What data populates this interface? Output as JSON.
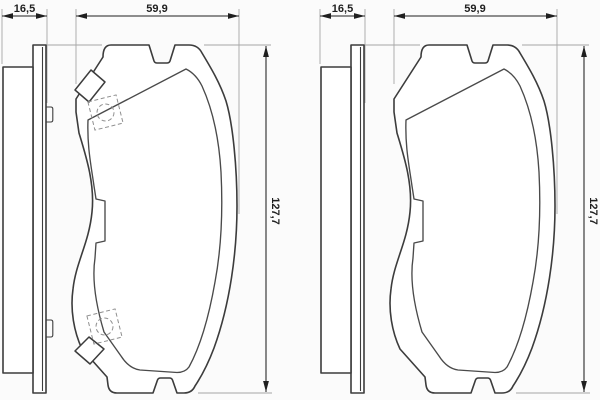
{
  "drawing": {
    "left_view": {
      "thickness": "16,5",
      "width": "59,9",
      "height": "127,7"
    },
    "right_view": {
      "thickness": "16,5",
      "width": "59,9",
      "height": "127,7"
    }
  },
  "colors": {
    "background": "#fbfbfb",
    "part_outline": "#3c3c3c",
    "inner_line": "#4a4a4a",
    "dimension": "#1f1f1f",
    "extension": "#a6a6a6",
    "marker_dashed": "#8f8f8f"
  }
}
